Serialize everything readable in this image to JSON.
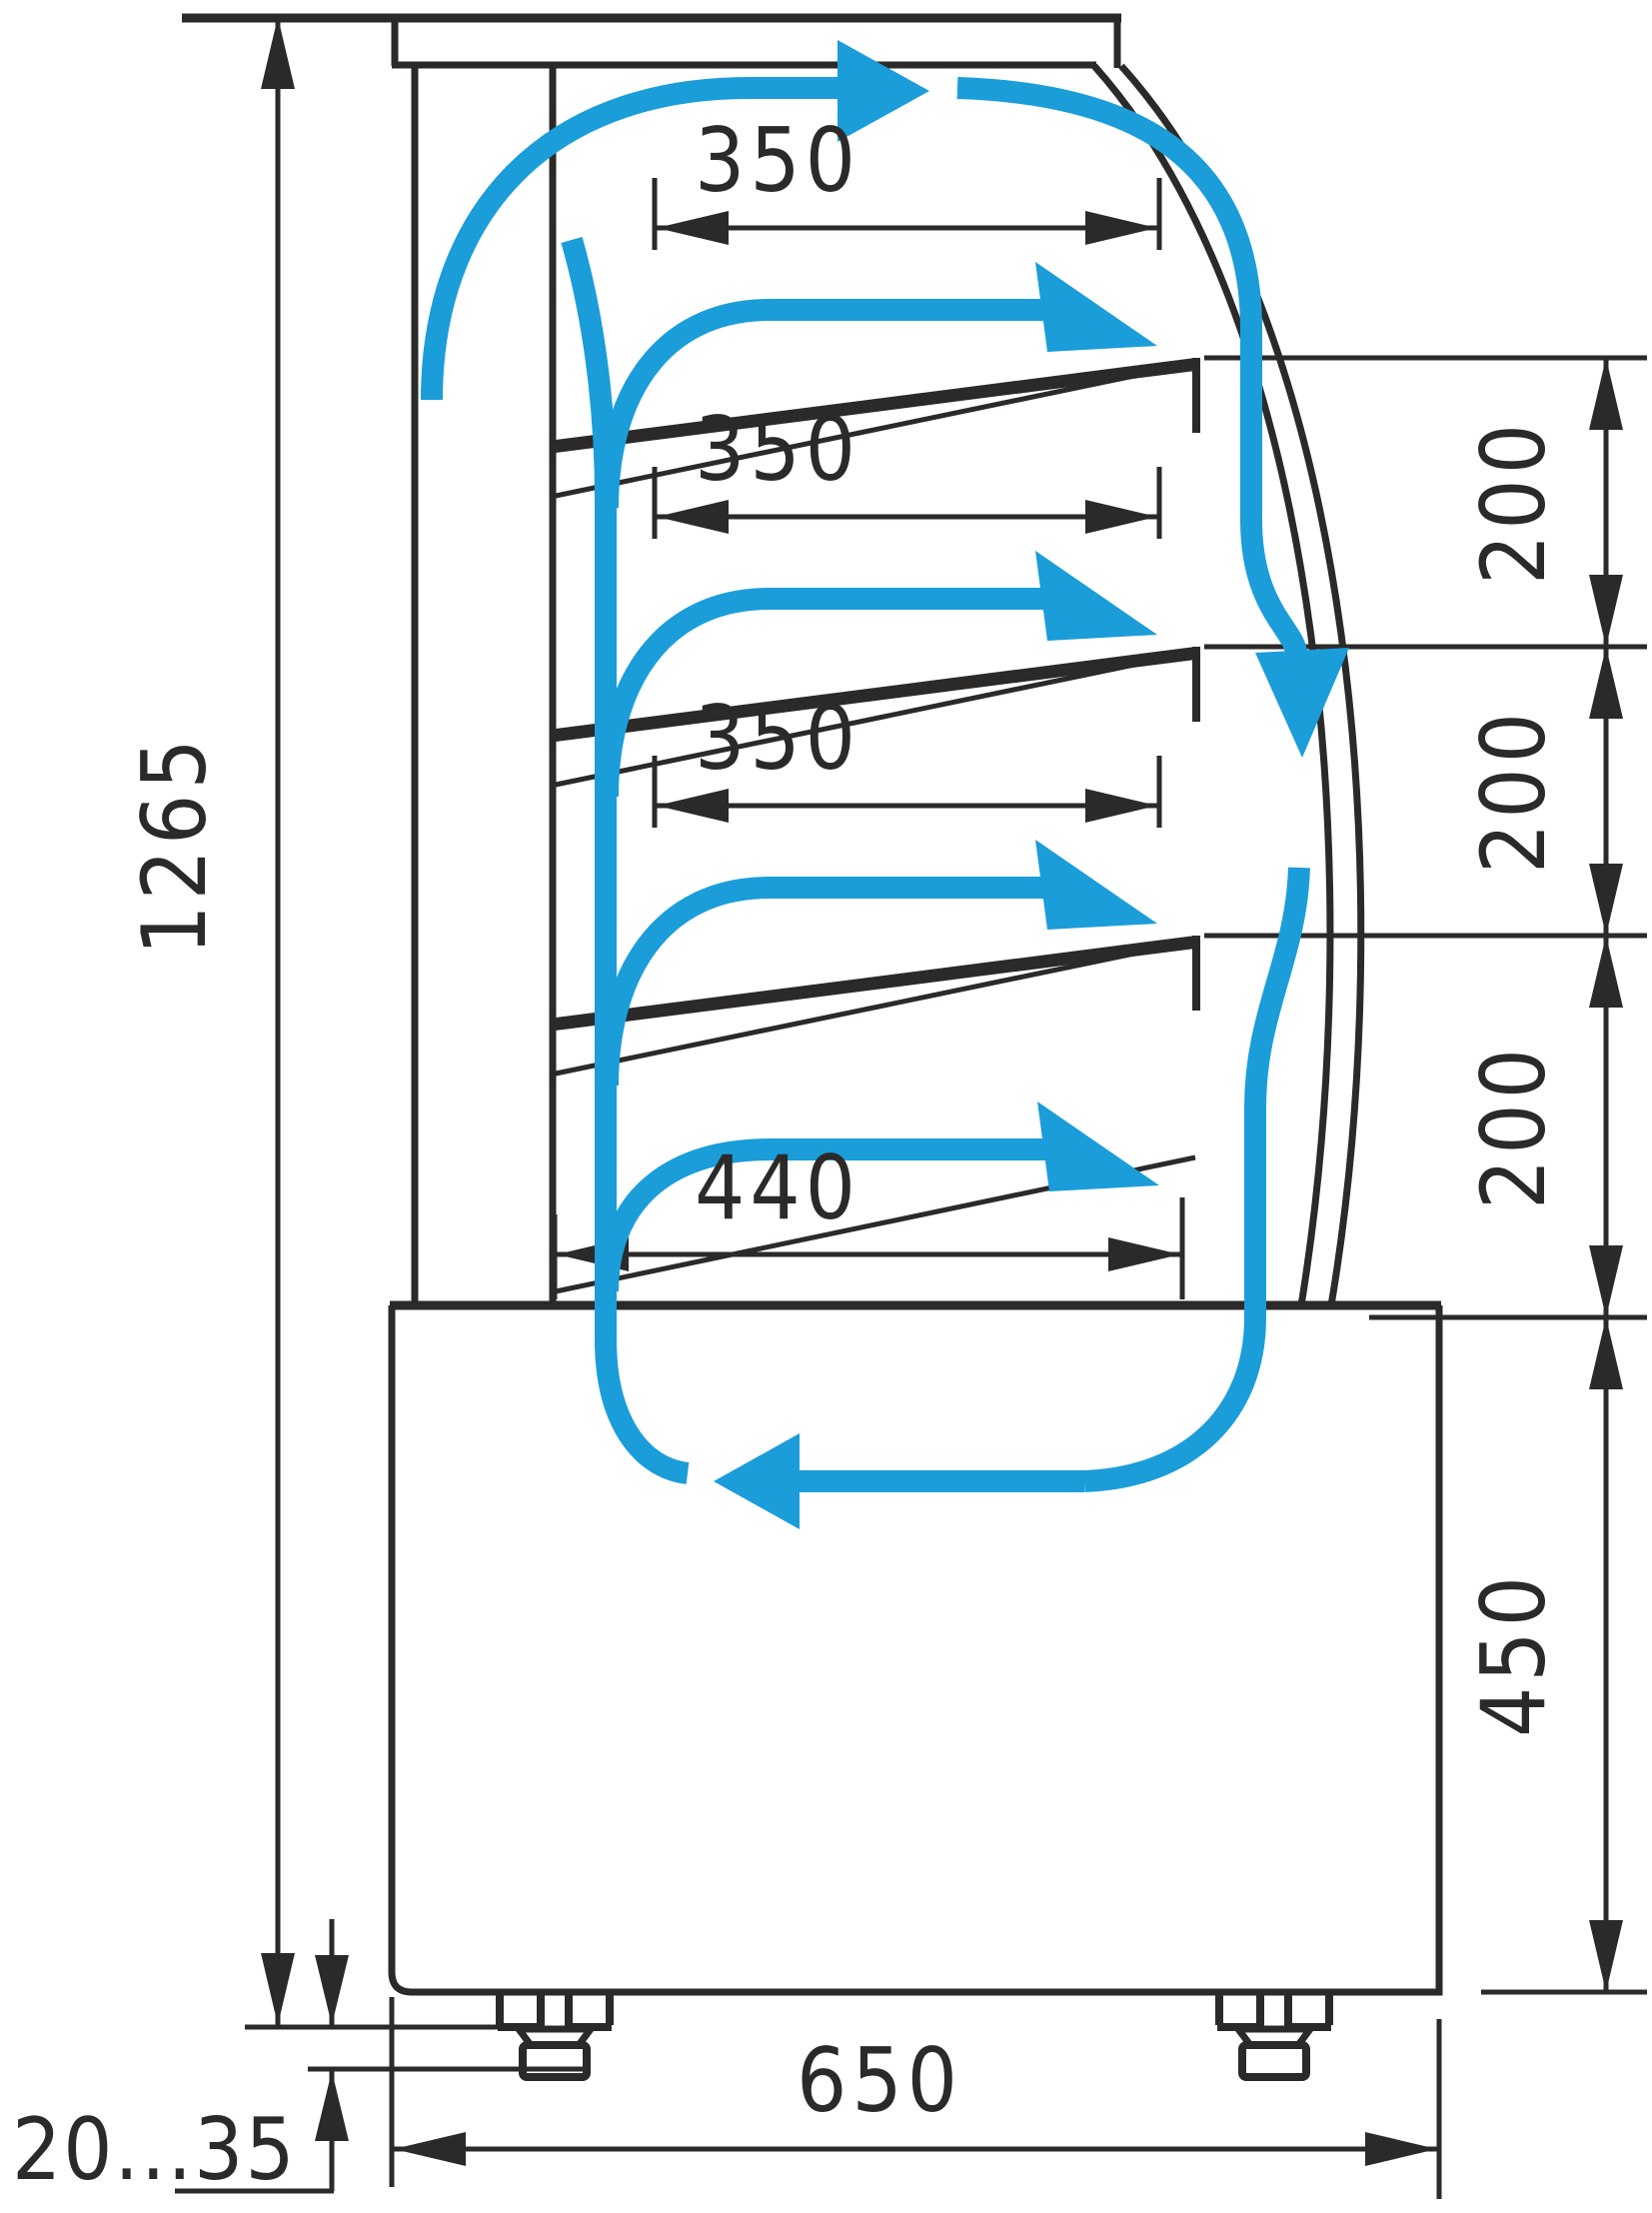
{
  "diagram": {
    "type": "technical-drawing",
    "subject": "refrigerated-display-case-side-section-with-airflow",
    "background_color": "#ffffff",
    "line_color": "#2b2a29",
    "airflow_color": "#1b9dd9"
  },
  "labels": {
    "total_height": "1265",
    "shelf_depth_1": "350",
    "shelf_depth_2": "350",
    "shelf_depth_3": "350",
    "bottom_shelf_depth": "440",
    "shelf_gap_1": "200",
    "shelf_gap_2": "200",
    "shelf_gap_3": "200",
    "base_height": "450",
    "base_depth": "650",
    "leg_adjust_range": "20...35"
  }
}
